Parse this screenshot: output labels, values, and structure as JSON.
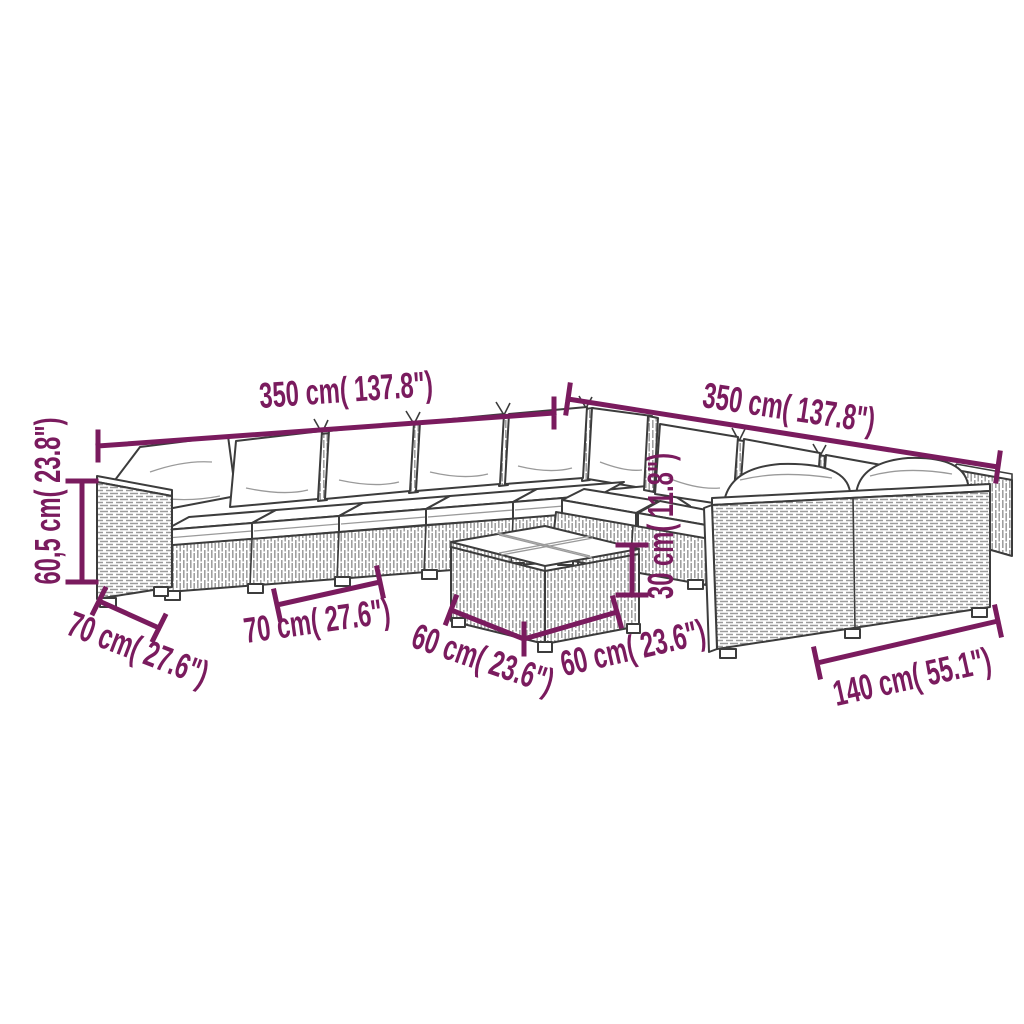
{
  "meta": {
    "accent_color": "#7a1b5e",
    "line_color": "#3c3c3c",
    "background_color": "#ffffff",
    "illustration": "modular-rattan-lounge-set-line-drawing"
  },
  "labels": {
    "sofa_left_run_length": "350 cm( 137.8\")",
    "sofa_right_run_length": "350 cm( 137.8\")",
    "seat_height": "60,5 cm( 23.8\")",
    "module_depth": "70 cm( 27.6\")",
    "module_width": "70 cm( 27.6\")",
    "table_width": "60 cm( 23.6\")",
    "table_depth": "60 cm( 23.6\")",
    "table_height": "30 cm( 11.8\")",
    "two_seater_width": "140 cm( 55.1\")"
  }
}
